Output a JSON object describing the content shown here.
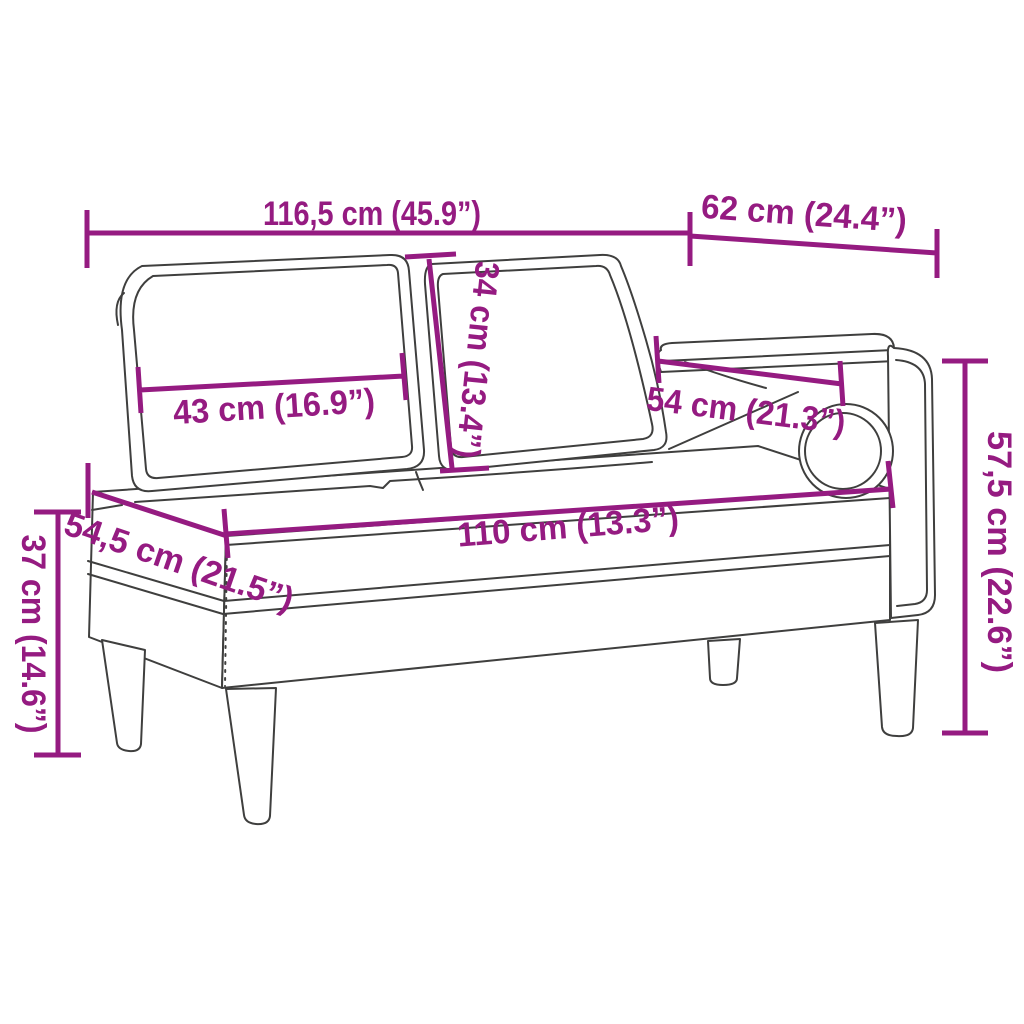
{
  "diagram": {
    "subject": "Chaise longue with two back cushions and bolster pillow — dimension line drawing",
    "accent_color": "#951B81",
    "line_color": "#3F3F3E",
    "background": "#FFFFFF",
    "dimensions": {
      "overall_width": "116,5 cm (45.9”)",
      "overall_depth": "62 cm (24.4”)",
      "back_cushion_height": "34 cm (13.4”)",
      "back_cushion_width": "43 cm (16.9”)",
      "armrest_length": "54 cm (21.3”)",
      "overall_height": "57,5 cm (22.6”)",
      "seat_length": "110 cm (13.3”)",
      "seat_depth": "54,5 cm (21.5”)",
      "seat_height": "37 cm (14.6”)"
    }
  }
}
